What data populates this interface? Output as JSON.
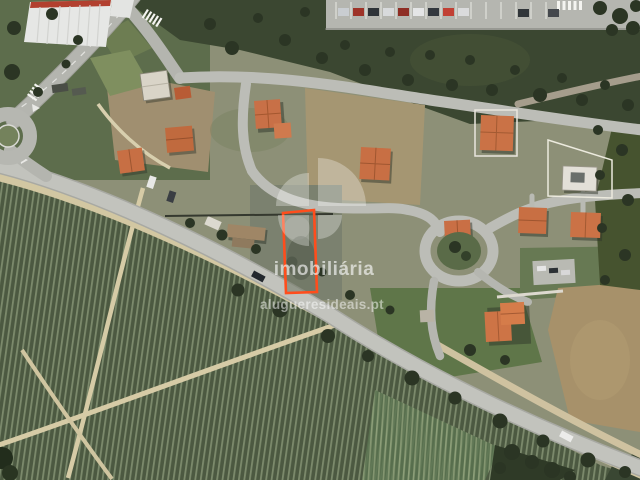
{
  "scene": {
    "type": "satellite-aerial-photo",
    "subject": "vacant building plot outlined in orange between a residential street and a vineyard"
  },
  "watermark": {
    "brand": "imobiliária",
    "website": "alugueresideais.pt",
    "logo_icon": "pinwheel-quarter-circles-logo",
    "text_color": "#ffffff"
  },
  "highlight": {
    "label": "property-boundary-outline",
    "color": "#ff4d1c"
  },
  "palette": {
    "road": "#c2c3bd",
    "vineyard": "#4c5941",
    "scrub": "#3b4731",
    "roof": "#c97045",
    "dirt": "#a59672"
  }
}
